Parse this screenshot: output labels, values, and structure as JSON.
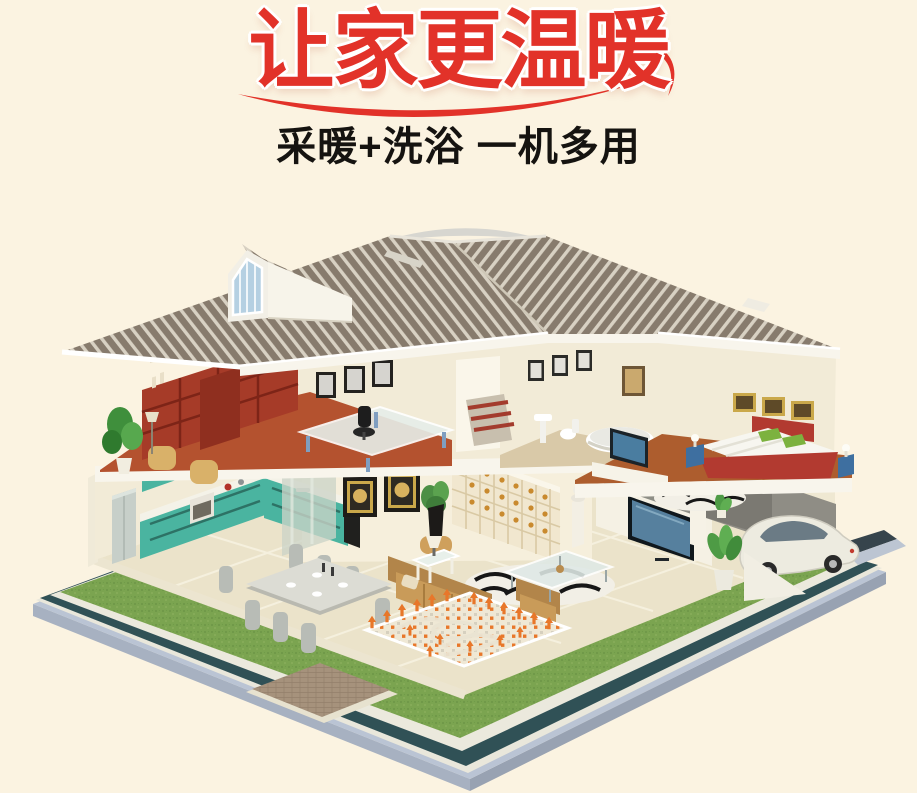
{
  "header": {
    "title": "让家更温暖",
    "subtitle": "采暖+洗浴  一机多用"
  },
  "palette": {
    "bg": "#fbf3e1",
    "title-red": "#e23229",
    "ink": "#151310",
    "roof-dark": "#877b6d",
    "roof-light": "#d8d1c3",
    "trim-white": "#f8f5ec",
    "wall-cream": "#f2ebd7",
    "wall-core": "#f6efdc",
    "floor-tile": "#ebe3ca",
    "terracotta": "#b4522f",
    "bedroom-floor": "#ad5d2e",
    "bookcase-red": "#a63b28",
    "kitchen-teal": "#4ab4a0",
    "kitchen-purple": "#8a6caa",
    "sofa-tan": "#c99b59",
    "sofa-tan-dark": "#b2854a",
    "grass": "#7ba450",
    "curb": "#ebe9dd",
    "slate": "#305156",
    "base-blue": "#bac4d4",
    "walkway": "#a6927c",
    "heat-orange": "#e8772a",
    "tv-screen": "#56809e",
    "glass-blue": "#b5d0e2",
    "bed-red": "#b23a30",
    "pillow-green": "#7cb23f",
    "car-body": "#edebe0",
    "chair-gray": "#b8bcb6"
  }
}
